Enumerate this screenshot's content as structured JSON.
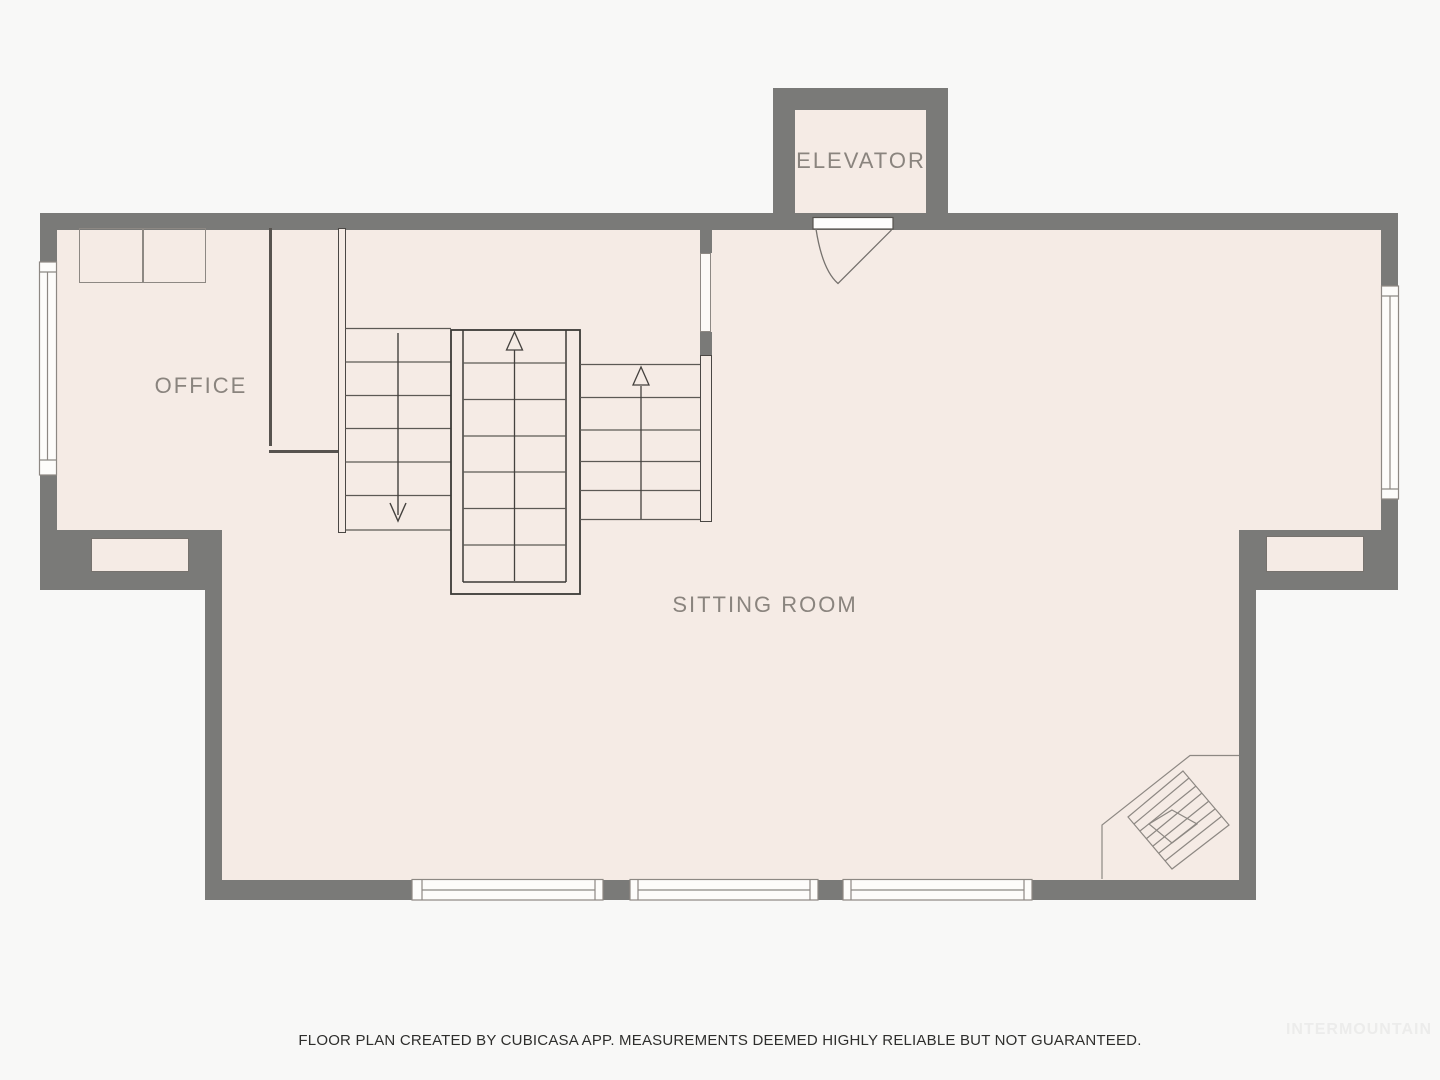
{
  "rooms": {
    "office": {
      "label": "OFFICE"
    },
    "sitting_room": {
      "label": "SITTING ROOM"
    },
    "elevator": {
      "label": "ELEVATOR"
    }
  },
  "stairs": {
    "left_flight_direction": "down",
    "middle_flight_direction": "up",
    "right_flight_direction": "up"
  },
  "features": {
    "fireplace": "corner-fireplace-bottom-right",
    "elevator_door": "swing-door",
    "window_count_bottom": 3,
    "window_count_left": 1,
    "window_count_right": 1
  },
  "footer": {
    "disclaimer": "FLOOR PLAN CREATED BY CUBICASA APP. MEASUREMENTS DEEMED HIGHLY RELIABLE BUT NOT GUARANTEED."
  },
  "watermark": {
    "label": "INTERMOUNTAIN"
  },
  "colors": {
    "wall": "#7a7a78",
    "floor": "#f5ebe5",
    "background": "#f8f8f7",
    "stair_line": "#5c5955",
    "stair_outline": "#3c3a37",
    "furniture_line": "#8d8883",
    "label_text": "#8a847e",
    "disclaimer_text": "#2e2e2c",
    "watermark_text": "#ececeb",
    "window_fill": "#fdfcfa"
  }
}
